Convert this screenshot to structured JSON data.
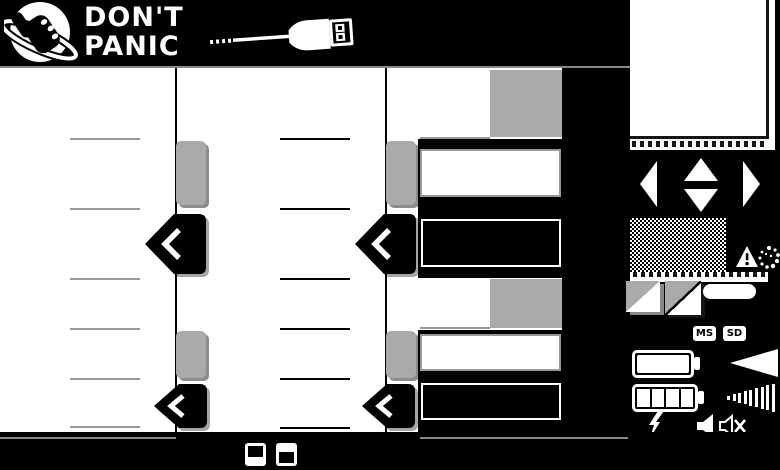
{
  "brand": {
    "line1": "DON'T",
    "line2": "PANIC"
  },
  "memory_badges": {
    "ms": "MS",
    "sd": "SD"
  },
  "size_selector": {
    "minus": "−",
    "small": "S",
    "medium": "M",
    "large": "L"
  },
  "colors": {
    "background": "#000000",
    "surface": "#ffffff",
    "handle_gray": "#aaaaaa",
    "line_gray": "#999999",
    "topbar_underline": "#888888"
  },
  "icons": {
    "logo": "thumb-globe-logo-icon",
    "usb": "usb-cable-icon",
    "dpad": [
      "dpad-left-icon",
      "dpad-up-icon",
      "dpad-down-icon",
      "dpad-right-icon"
    ],
    "warning": "warning-triangle-icon",
    "dust": "dust-particles-icon",
    "thumbnails": [
      "photo-thumbnail-gray-icon",
      "photo-thumbnail-diagonal-icon"
    ],
    "battery_full": "battery-full-icon",
    "battery_segmented": "battery-level-icon",
    "volume_solid": "volume-wedge-icon",
    "volume_bars": "volume-bars-icon",
    "flash": "flash-bolt-icon",
    "speaker": "speaker-icon",
    "speaker_muted": "speaker-mute-icon",
    "display_modes": [
      "display-top-half-icon",
      "display-bottom-half-icon"
    ]
  }
}
